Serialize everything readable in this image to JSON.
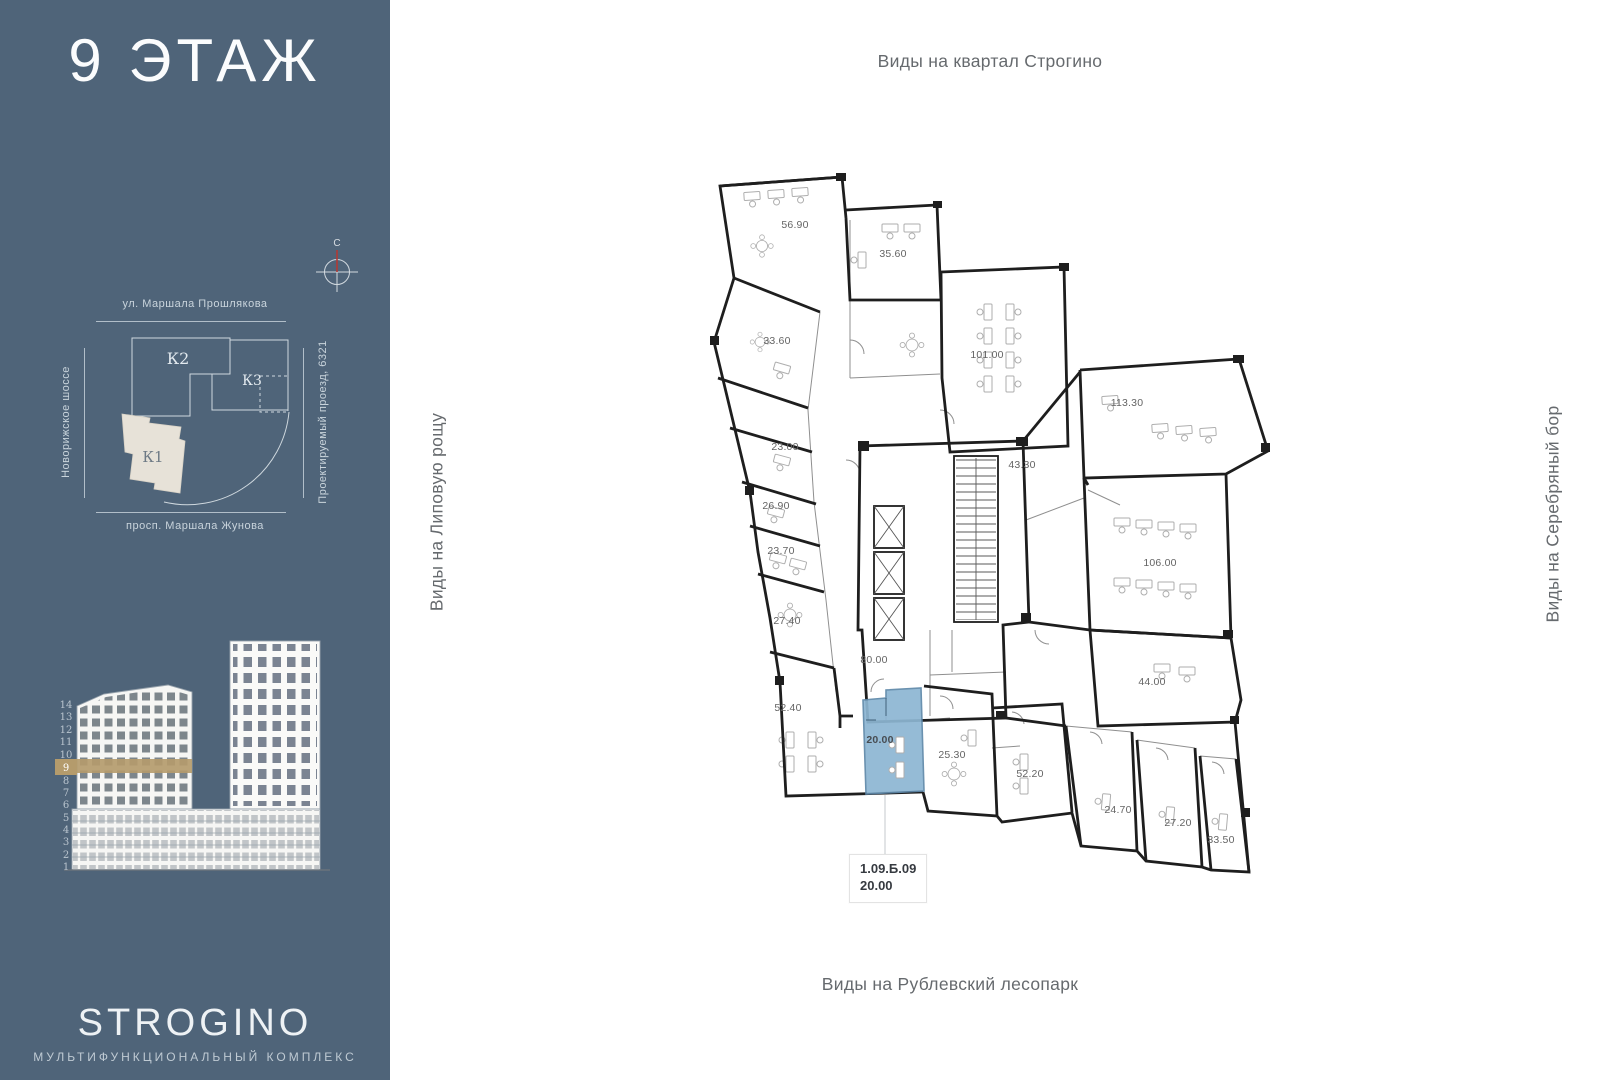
{
  "sidebar": {
    "floor_title": "9 ЭТАЖ",
    "compass": {
      "north_label": "С"
    },
    "site_map": {
      "street_top": "ул. Маршала Прошлякова",
      "street_left": "Новорижское шоссе",
      "street_right": "Проектируемый проезд, 6321",
      "street_bottom": "просп. Маршала Жунова",
      "building_k2": "К2",
      "building_k3": "К3",
      "building_k1": "К1"
    },
    "elevation": {
      "floors": [
        "14",
        "13",
        "12",
        "11",
        "10",
        "9",
        "8",
        "7",
        "6",
        "5",
        "4",
        "3",
        "2",
        "1"
      ],
      "current_floor": "9"
    },
    "logo": {
      "title": "STROGINO",
      "subtitle": "МУЛЬТИФУНКЦИОНАЛЬНЫЙ КОМПЛЕКС"
    }
  },
  "main": {
    "view_labels": {
      "top": "Виды на квартал Строгино",
      "left": "Виды на Липовую рощу",
      "right": "Виды на Серебряный бор",
      "bottom": "Виды на Рублевский лесопарк"
    },
    "plan": {
      "area_labels": [
        "56.90",
        "35.60",
        "33.60",
        "101.00",
        "23.00",
        "43.30",
        "113.30",
        "26.90",
        "23.70",
        "106.00",
        "27.40",
        "80.00",
        "44.00",
        "52.40",
        "20.00",
        "25.30",
        "52.20",
        "24.70",
        "27.20",
        "33.50"
      ],
      "callout": {
        "unit_code": "1.09.Б.09",
        "area": "20.00"
      }
    }
  },
  "colors": {
    "sidebar_bg": "#4f6479",
    "accent_gold": "#b49b6c",
    "unit_blue": "#8db6d3"
  }
}
